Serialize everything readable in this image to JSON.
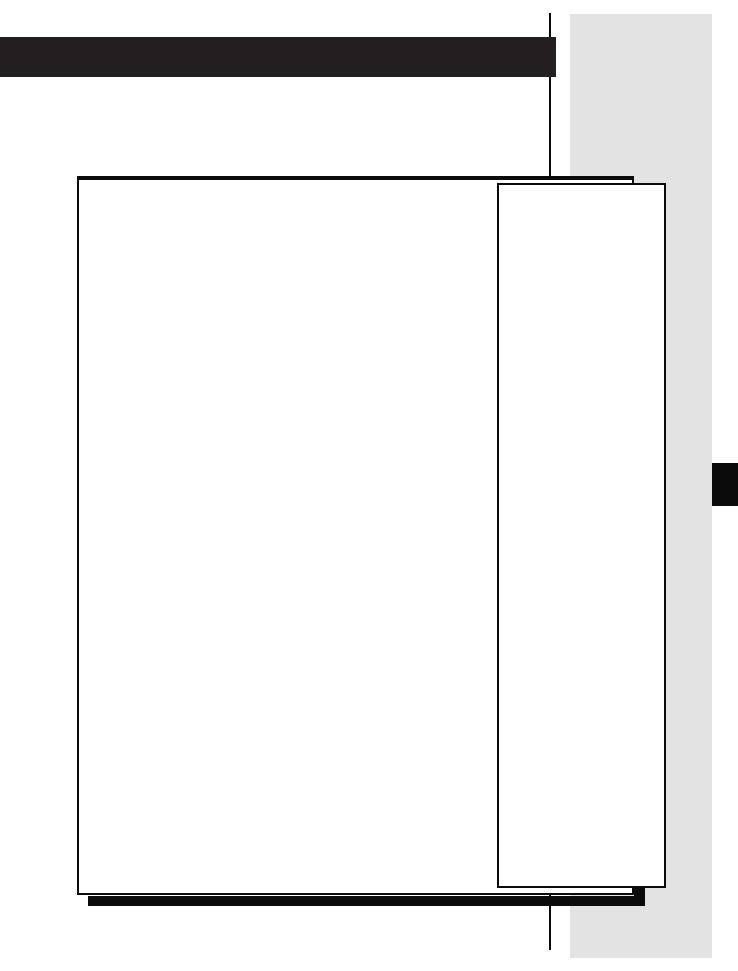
{
  "colors": {
    "paper": "#ffffff",
    "ink": "#0b0b0b",
    "title-bar": "#231f20",
    "margin-strip": "#e4e3e3"
  },
  "content": {
    "title_bar_text": "",
    "figure_frame_content": "",
    "sidebar_note_content": ""
  }
}
